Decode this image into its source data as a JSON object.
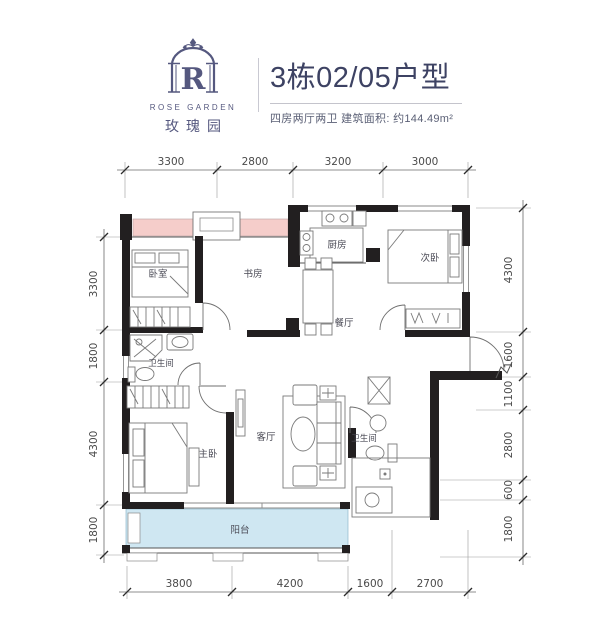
{
  "header": {
    "logo": {
      "letter": "R",
      "brand_en": "ROSE GARDEN",
      "brand_cn": "玫瑰园"
    },
    "title": "3栋02/05户型",
    "subtitle": "四房两厅两卫 建筑面积: 约144.49m²"
  },
  "floorplan": {
    "rooms": {
      "bedroom": "卧室",
      "study": "书房",
      "kitchen": "厨房",
      "second_bedroom": "次卧",
      "dining": "餐厅",
      "bathroom_upper": "卫生间",
      "master_bedroom": "主卧",
      "living": "客厅",
      "bathroom_lower": "卫生间",
      "balcony": "阳台"
    },
    "dimensions_mm": {
      "top": [
        "3300",
        "2800",
        "3200",
        "3000"
      ],
      "bottom": [
        "3800",
        "4200",
        "1600",
        "2700"
      ],
      "left": [
        "3300",
        "1800",
        "4300",
        "1800"
      ],
      "right": [
        "4300",
        "1600",
        "1100",
        "2800",
        "600",
        "1800"
      ]
    }
  },
  "colors": {
    "title_navy": "#3d4263",
    "logo_purple": "#55587f",
    "bay_window_pink": "#f5cdca",
    "balcony_blue": "#cfe7f2",
    "wall_dark": "#221f20",
    "dimension_gray": "#4a4a4a"
  }
}
